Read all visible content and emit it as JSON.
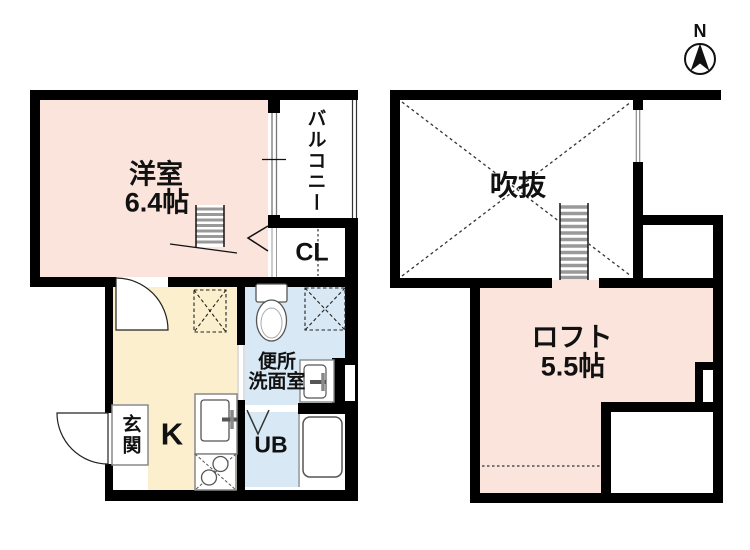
{
  "compass": {
    "label": "N"
  },
  "colors": {
    "room_pink": "#fae4dc",
    "kitchen_cream": "#fcefce",
    "bath_blue": "#d8e9f5",
    "wall_black": "#000000"
  },
  "floor1": {
    "western_room_name": "洋室",
    "western_room_size": "6.4帖",
    "balcony_label": "バルコニー",
    "closet_label": "CL",
    "kitchen_label": "K",
    "washroom_label_line1": "便所",
    "washroom_label_line2": "洗面室",
    "unit_bath_label": "UB",
    "entrance_label": "玄関"
  },
  "floor2": {
    "void_label": "吹抜",
    "loft_name": "ロフト",
    "loft_size": "5.5帖"
  }
}
